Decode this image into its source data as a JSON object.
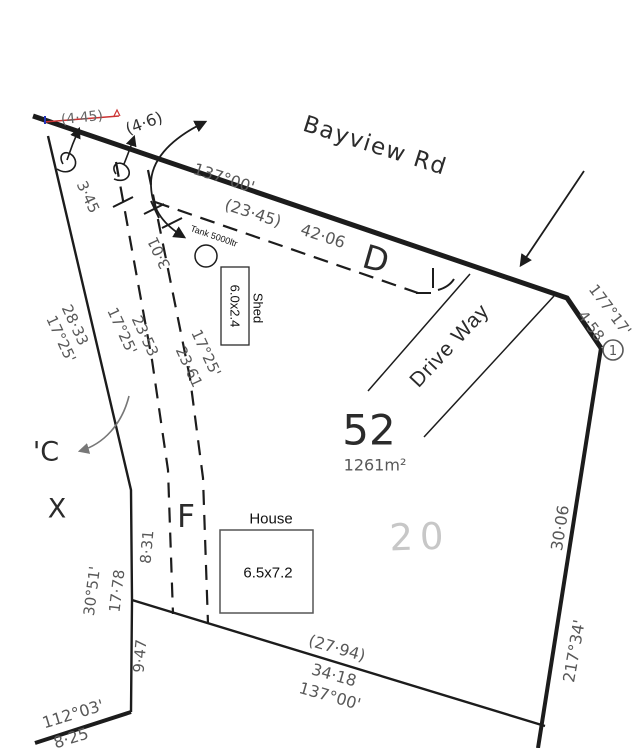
{
  "plan": {
    "road_name": "Bayview Rd",
    "lot": {
      "number": "52",
      "area": "1261m²",
      "underlay_number": "20"
    },
    "house": {
      "label": "House",
      "size": "6.5x7.2"
    },
    "shed": {
      "label": "Shed",
      "size": "6.0x2.4"
    },
    "tank": {
      "label": "Tank 5000ltr"
    },
    "driveway_label": "Drive Way",
    "letters": {
      "d": "D",
      "f": "F",
      "c": "'C",
      "x": "X"
    },
    "corner_marker": "1",
    "notes": {
      "struck_value": "(4·45)",
      "revised_value": "(4·6)"
    },
    "dimensions": {
      "road_bearing": "137°00'",
      "road_dist_paren": "(23·45)",
      "road_dist": "42·06",
      "seg_345": "3·45",
      "west_upper_dist": "28·33",
      "west_upper_bear": "17°25'",
      "dash1_bear": "17°25'",
      "dash1_dist": "23·53",
      "dash2_dist": "23·61",
      "dash2_bear": "17°25'",
      "seg_301": "3·01",
      "corner_bear": "177°17'",
      "corner_dist": "4·58",
      "east_dist": "30·06",
      "east_bear": "217°34'",
      "south_dist_paren": "(27·94)",
      "south_dist": "34·18",
      "south_bear": "137°00'",
      "seg_831": "8·31",
      "west_lower_bear": "30°51'",
      "west_lower_dist": "17·78",
      "seg_947": "9·47",
      "sw_bear": "112°03'",
      "sw_dist": "8·25"
    },
    "colors": {
      "line": "#1c1c1c",
      "survey_text": "#585858",
      "label_text": "#2b2b2b",
      "faded_number": "#c7c7c7",
      "strike_red": "#cc3333",
      "mark_blue": "#2233bb",
      "arrow_gray": "#777777"
    }
  }
}
